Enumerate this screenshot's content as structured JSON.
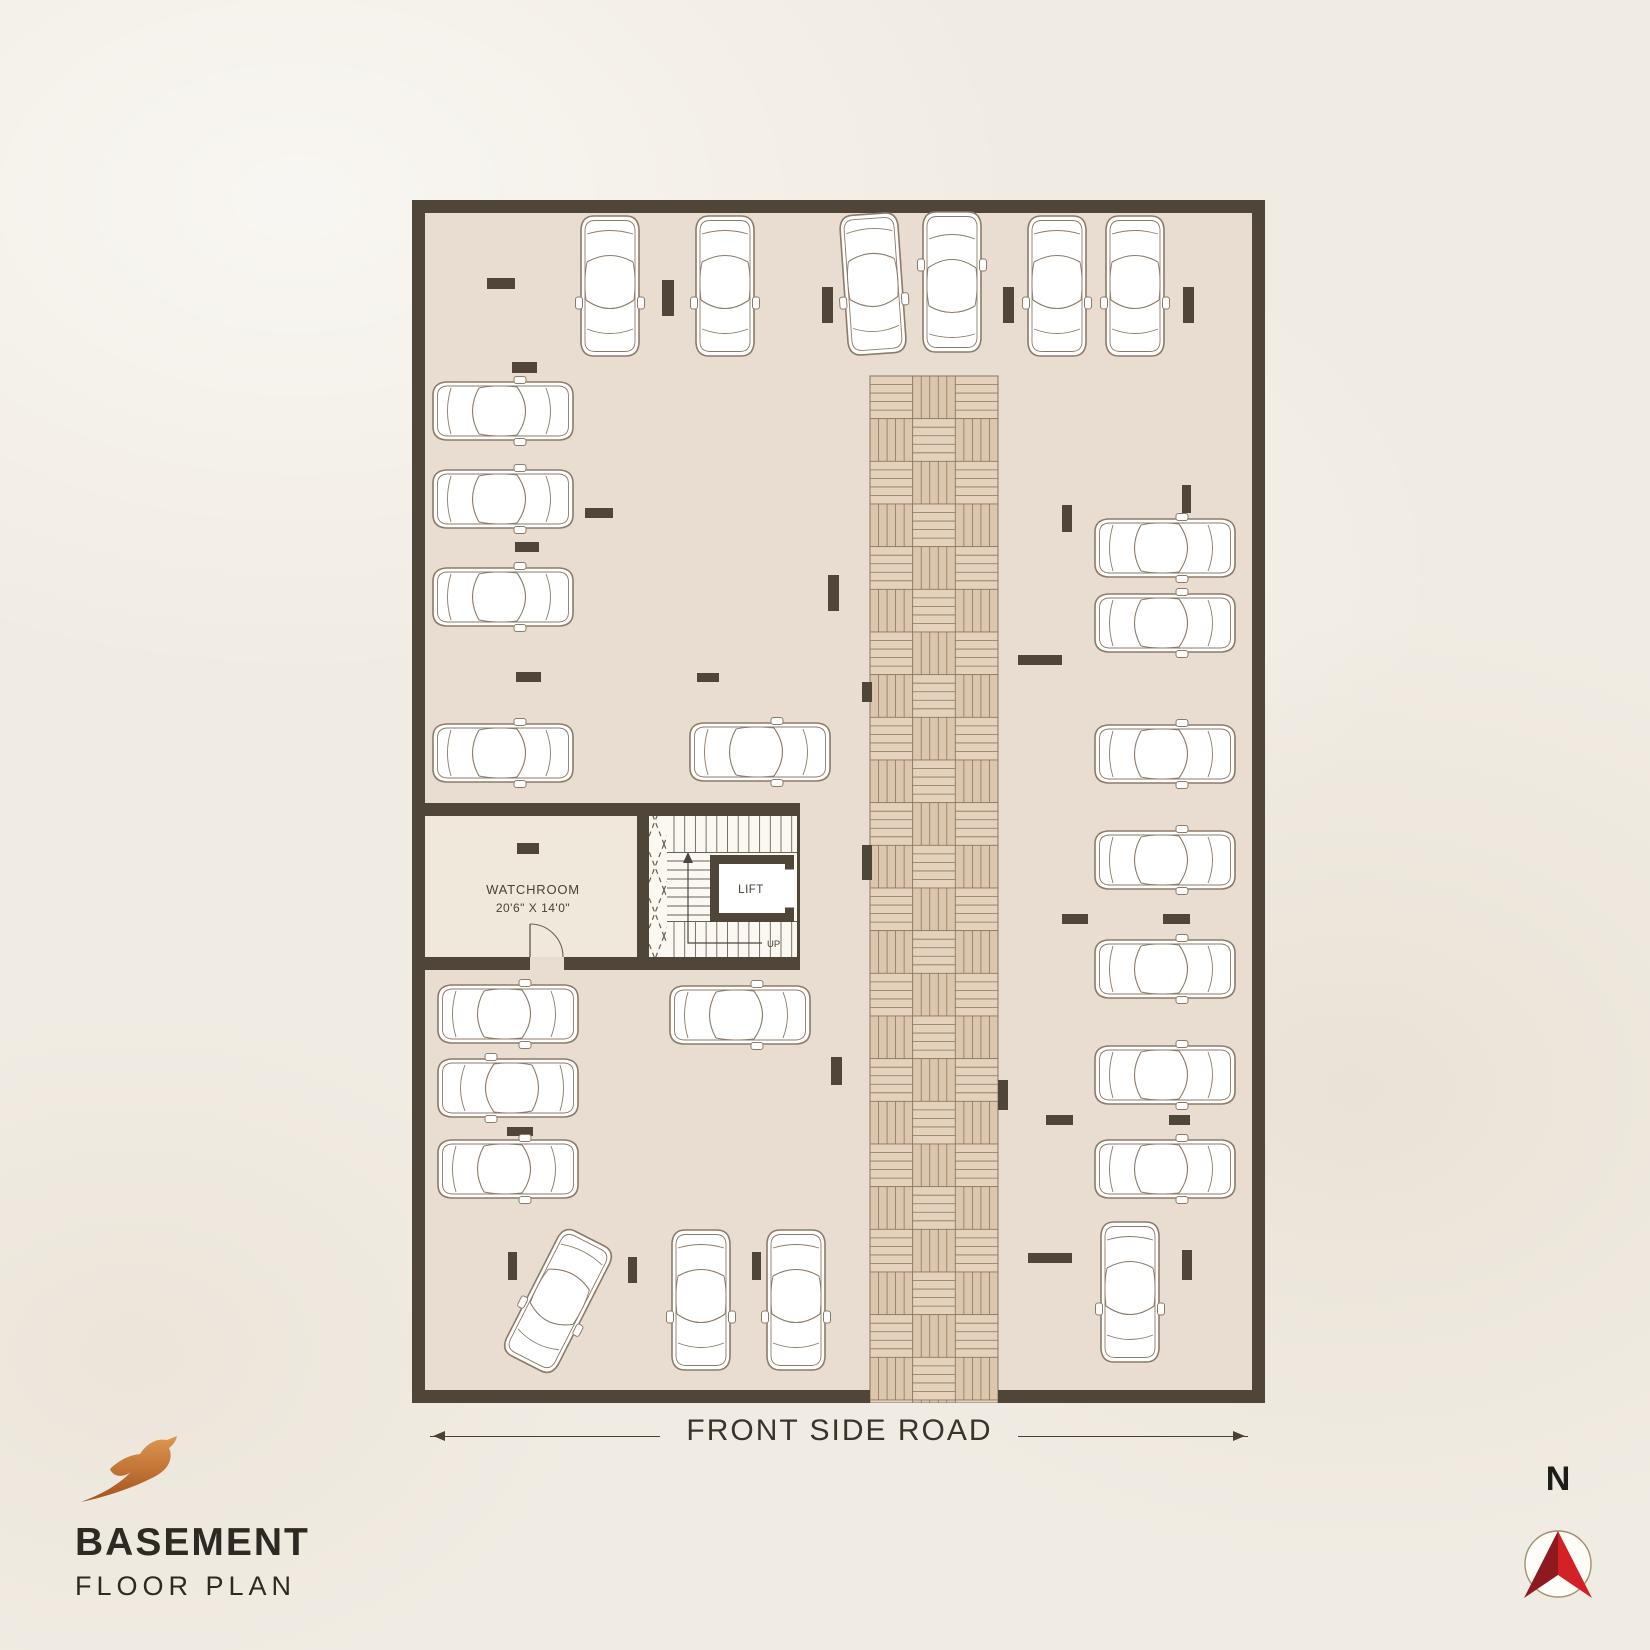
{
  "page": {
    "width": 1650,
    "height": 1650,
    "background": "#f1ece3"
  },
  "branding": {
    "logo_icon": "bird-logo",
    "title": "BASEMENT",
    "subtitle": "FLOOR PLAN",
    "logo_gradient_top": "#df9750",
    "logo_gradient_bottom": "#a4521d",
    "text_color": "#2d2a23"
  },
  "road": {
    "label": "FRONT SIDE ROAD",
    "text_color": "#3a352c"
  },
  "compass": {
    "label": "N",
    "arrow_dark": "#8e1a1f",
    "arrow_light": "#d42027",
    "ring_color": "#a39072"
  },
  "plan": {
    "x": 412,
    "y": 200,
    "width": 853,
    "height": 1203,
    "wall_thickness": 13,
    "colors": {
      "wall": "#4f4639",
      "floor": "#e8ddd0",
      "room_floor": "#efe8db",
      "stair_bg": "#fbf8f2",
      "car_line": "#8d7a68",
      "parquet_a": "#dcc7ae",
      "parquet_b": "#e4d2bd",
      "parquet_line": "#8a765f",
      "label_ink": "#4a4238"
    },
    "driveway": {
      "x": 458,
      "top": 176,
      "width": 128,
      "columns": 3
    },
    "watchroom": {
      "name": "WATCHROOM",
      "dimensions": "20'6\" X 14'0\""
    },
    "lift": {
      "name": "LIFT"
    },
    "stairs": {
      "up_label": "UP"
    },
    "cars": [
      [
        198,
        86,
        180
      ],
      [
        313,
        86,
        180
      ],
      [
        461,
        84,
        176
      ],
      [
        540,
        82,
        0
      ],
      [
        645,
        86,
        180
      ],
      [
        723,
        86,
        180
      ],
      [
        91,
        211,
        90
      ],
      [
        91,
        299,
        90
      ],
      [
        91,
        397,
        90
      ],
      [
        91,
        553,
        90
      ],
      [
        348,
        552,
        90
      ],
      [
        753,
        348,
        90
      ],
      [
        753,
        423,
        90
      ],
      [
        753,
        554,
        90
      ],
      [
        753,
        660,
        90
      ],
      [
        753,
        769,
        90
      ],
      [
        753,
        875,
        90
      ],
      [
        753,
        969,
        90
      ],
      [
        96,
        814,
        90
      ],
      [
        96,
        888,
        270
      ],
      [
        96,
        969,
        90
      ],
      [
        328,
        815,
        90
      ],
      [
        146,
        1101,
        207
      ],
      [
        289,
        1100,
        180
      ],
      [
        384,
        1100,
        180
      ],
      [
        718,
        1092,
        180
      ]
    ],
    "stubs": [
      [
        75,
        78,
        28,
        11
      ],
      [
        100,
        162,
        25,
        11
      ],
      [
        250,
        80,
        12,
        36
      ],
      [
        410,
        87,
        11,
        36
      ],
      [
        591,
        87,
        11,
        36
      ],
      [
        771,
        87,
        11,
        36
      ],
      [
        103,
        342,
        24,
        10
      ],
      [
        104,
        472,
        25,
        10
      ],
      [
        173,
        308,
        28,
        10
      ],
      [
        285,
        473,
        22,
        9
      ],
      [
        416,
        375,
        11,
        36
      ],
      [
        450,
        482,
        10,
        20
      ],
      [
        450,
        645,
        10,
        35
      ],
      [
        419,
        857,
        11,
        28
      ],
      [
        586,
        880,
        10,
        30
      ],
      [
        105,
        643,
        22,
        11
      ],
      [
        95,
        927,
        26,
        9
      ],
      [
        96,
        1052,
        9,
        28
      ],
      [
        216,
        1057,
        9,
        26
      ],
      [
        340,
        1052,
        9,
        28
      ],
      [
        650,
        305,
        10,
        27
      ],
      [
        770,
        285,
        9,
        28
      ],
      [
        606,
        455,
        44,
        10
      ],
      [
        650,
        714,
        26,
        10
      ],
      [
        751,
        714,
        27,
        10
      ],
      [
        634,
        915,
        27,
        10
      ],
      [
        757,
        915,
        21,
        10
      ],
      [
        616,
        1053,
        44,
        10
      ],
      [
        770,
        1050,
        10,
        30
      ]
    ]
  }
}
